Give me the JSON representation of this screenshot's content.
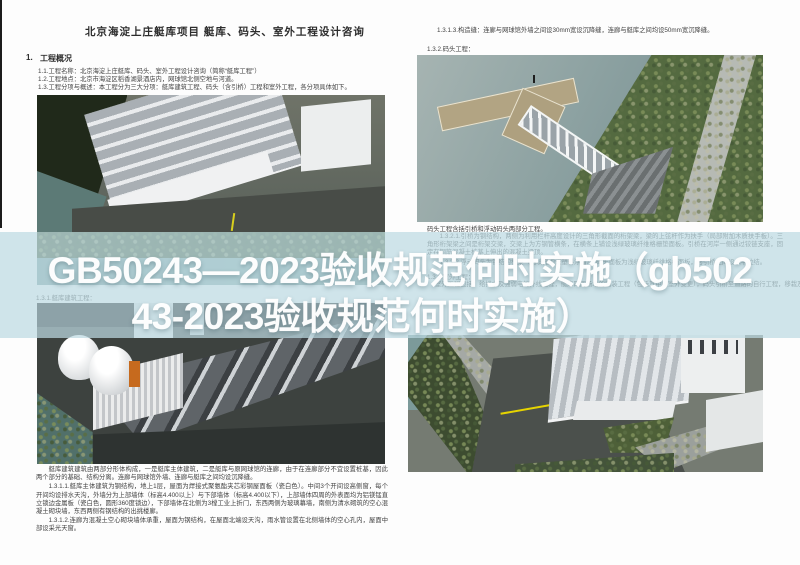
{
  "article": {
    "full_title": "GB50243—2023验收规范何时实施（gb50243-2023验收规范何时实施）",
    "overlay_line1": "GB50243—2023验收规范何时实施（gb502",
    "overlay_line2": "43-2023验收规范何时实施）",
    "overlay_text_color": "#ffffff",
    "overlay_band_color": "#c4dbe2"
  },
  "left_page": {
    "header": "北京海淀上庄艇库项目 艇库、码头、室外工程设计咨询",
    "section_no": "1.",
    "section_heading": "工程概况",
    "overview_lines": [
      "1.1.工程名称：北京海淀上庄艇库、码头、室外工程设计咨询（简称“艇库工程”）",
      "1.2.工程地点：北京市海淀区稻香湖景酒店内，网球馆北侧空地与河道。",
      "1.3.工程分项与概述：本工程分为三大分项：艇库建筑工程、码头（含引桥）工程和室外工程，各分项具体如下。"
    ],
    "caption_building_works": "1.3.1.艇库建筑工程：",
    "body_paragraphs": [
      "艇库建筑建筑由两部分形体构成，一是艇库主体建筑，二是艇库与原网球馆的连廊，由于在连廊部分不宜设置桩基，因此两个部分的基础、结构分离。连廊与网球馆外墙、连廊与艇库之间均设沉降缝。",
      "1.3.1.1.艇库主体建筑为钢结构，地上1层，屋面为焊接式聚氨酯夹芯彩钢屋面板（瓷白色）。中间3个开间设高侧窗，每个开间均设排水天沟，外墙分为上部墙体（标高4.400以上）与下部墙体（标高4.400以下），上部墙体四周的外表面均为铝镁锰直立锁边金属板（瓷白色，圆形360度锁边），下部墙体在北侧为3樘工业上折门，东西两侧为玻璃幕墙，南侧为清水砌筑的空心混凝土砌块墙，东西两侧有钢结构的出挑楼廊。",
      "1.3.1.2.连廊为混凝土空心砌块墙体承重，屋面为钢结构，在屋面北端设天沟，雨水管设置在北侧墙体的空心孔内，屋面中部设采光天窗。"
    ]
  },
  "right_page": {
    "joint_line": "1.3.1.3.构造缝：连廊与网球馆外墙之间设30mm宽设沉降缝，连廊与艇库之间均设50mm宽沉降缝。",
    "caption_dock_works": "1.3.2.码头工程：",
    "dock_summary": "码头工程含括引桥和浮动码头两部分工程。",
    "band_paragraphs": [
      "1.3.2.1.引桥为钢结构，两侧为利用栏杆高度设计的三角形截面的桁架梁，梁的上弦杆作为扶手（局部附加木质扶手板）。三角形桁架梁之间是桁架交梁，交梁上为方钢管横条，在横条上铺设浅绿玻璃纤维格栅垫面板。引桥在河岸一侧通过铰链支座，固定在钢筋混凝土桩基上伸出的混凝土梁顶。",
      "1.3.2.2.浮动码头为钢结构框架（内填充泡沫塑料浮箱），码头面板为浅绿玻璃纤维格栅面板，与引桥之间设水平拉结。"
    ],
    "caption_outdoor_works": "1.3.3.室外工程：",
    "outdoor_line": "室外工程包括：给排水及强弱电的外线工程，艇库四周场地的铺装工程（包括其中的室外变更），码头引桥至道路的自行工程，移栽及新种树木"
  },
  "palette": {
    "band_tint": "#c4dbe2",
    "water": "#7d9c9c",
    "asphalt": "#4b4f4b",
    "foliage": "#55693f",
    "road_marking_yellow": "#e6d400",
    "doc_text": "#424242"
  }
}
